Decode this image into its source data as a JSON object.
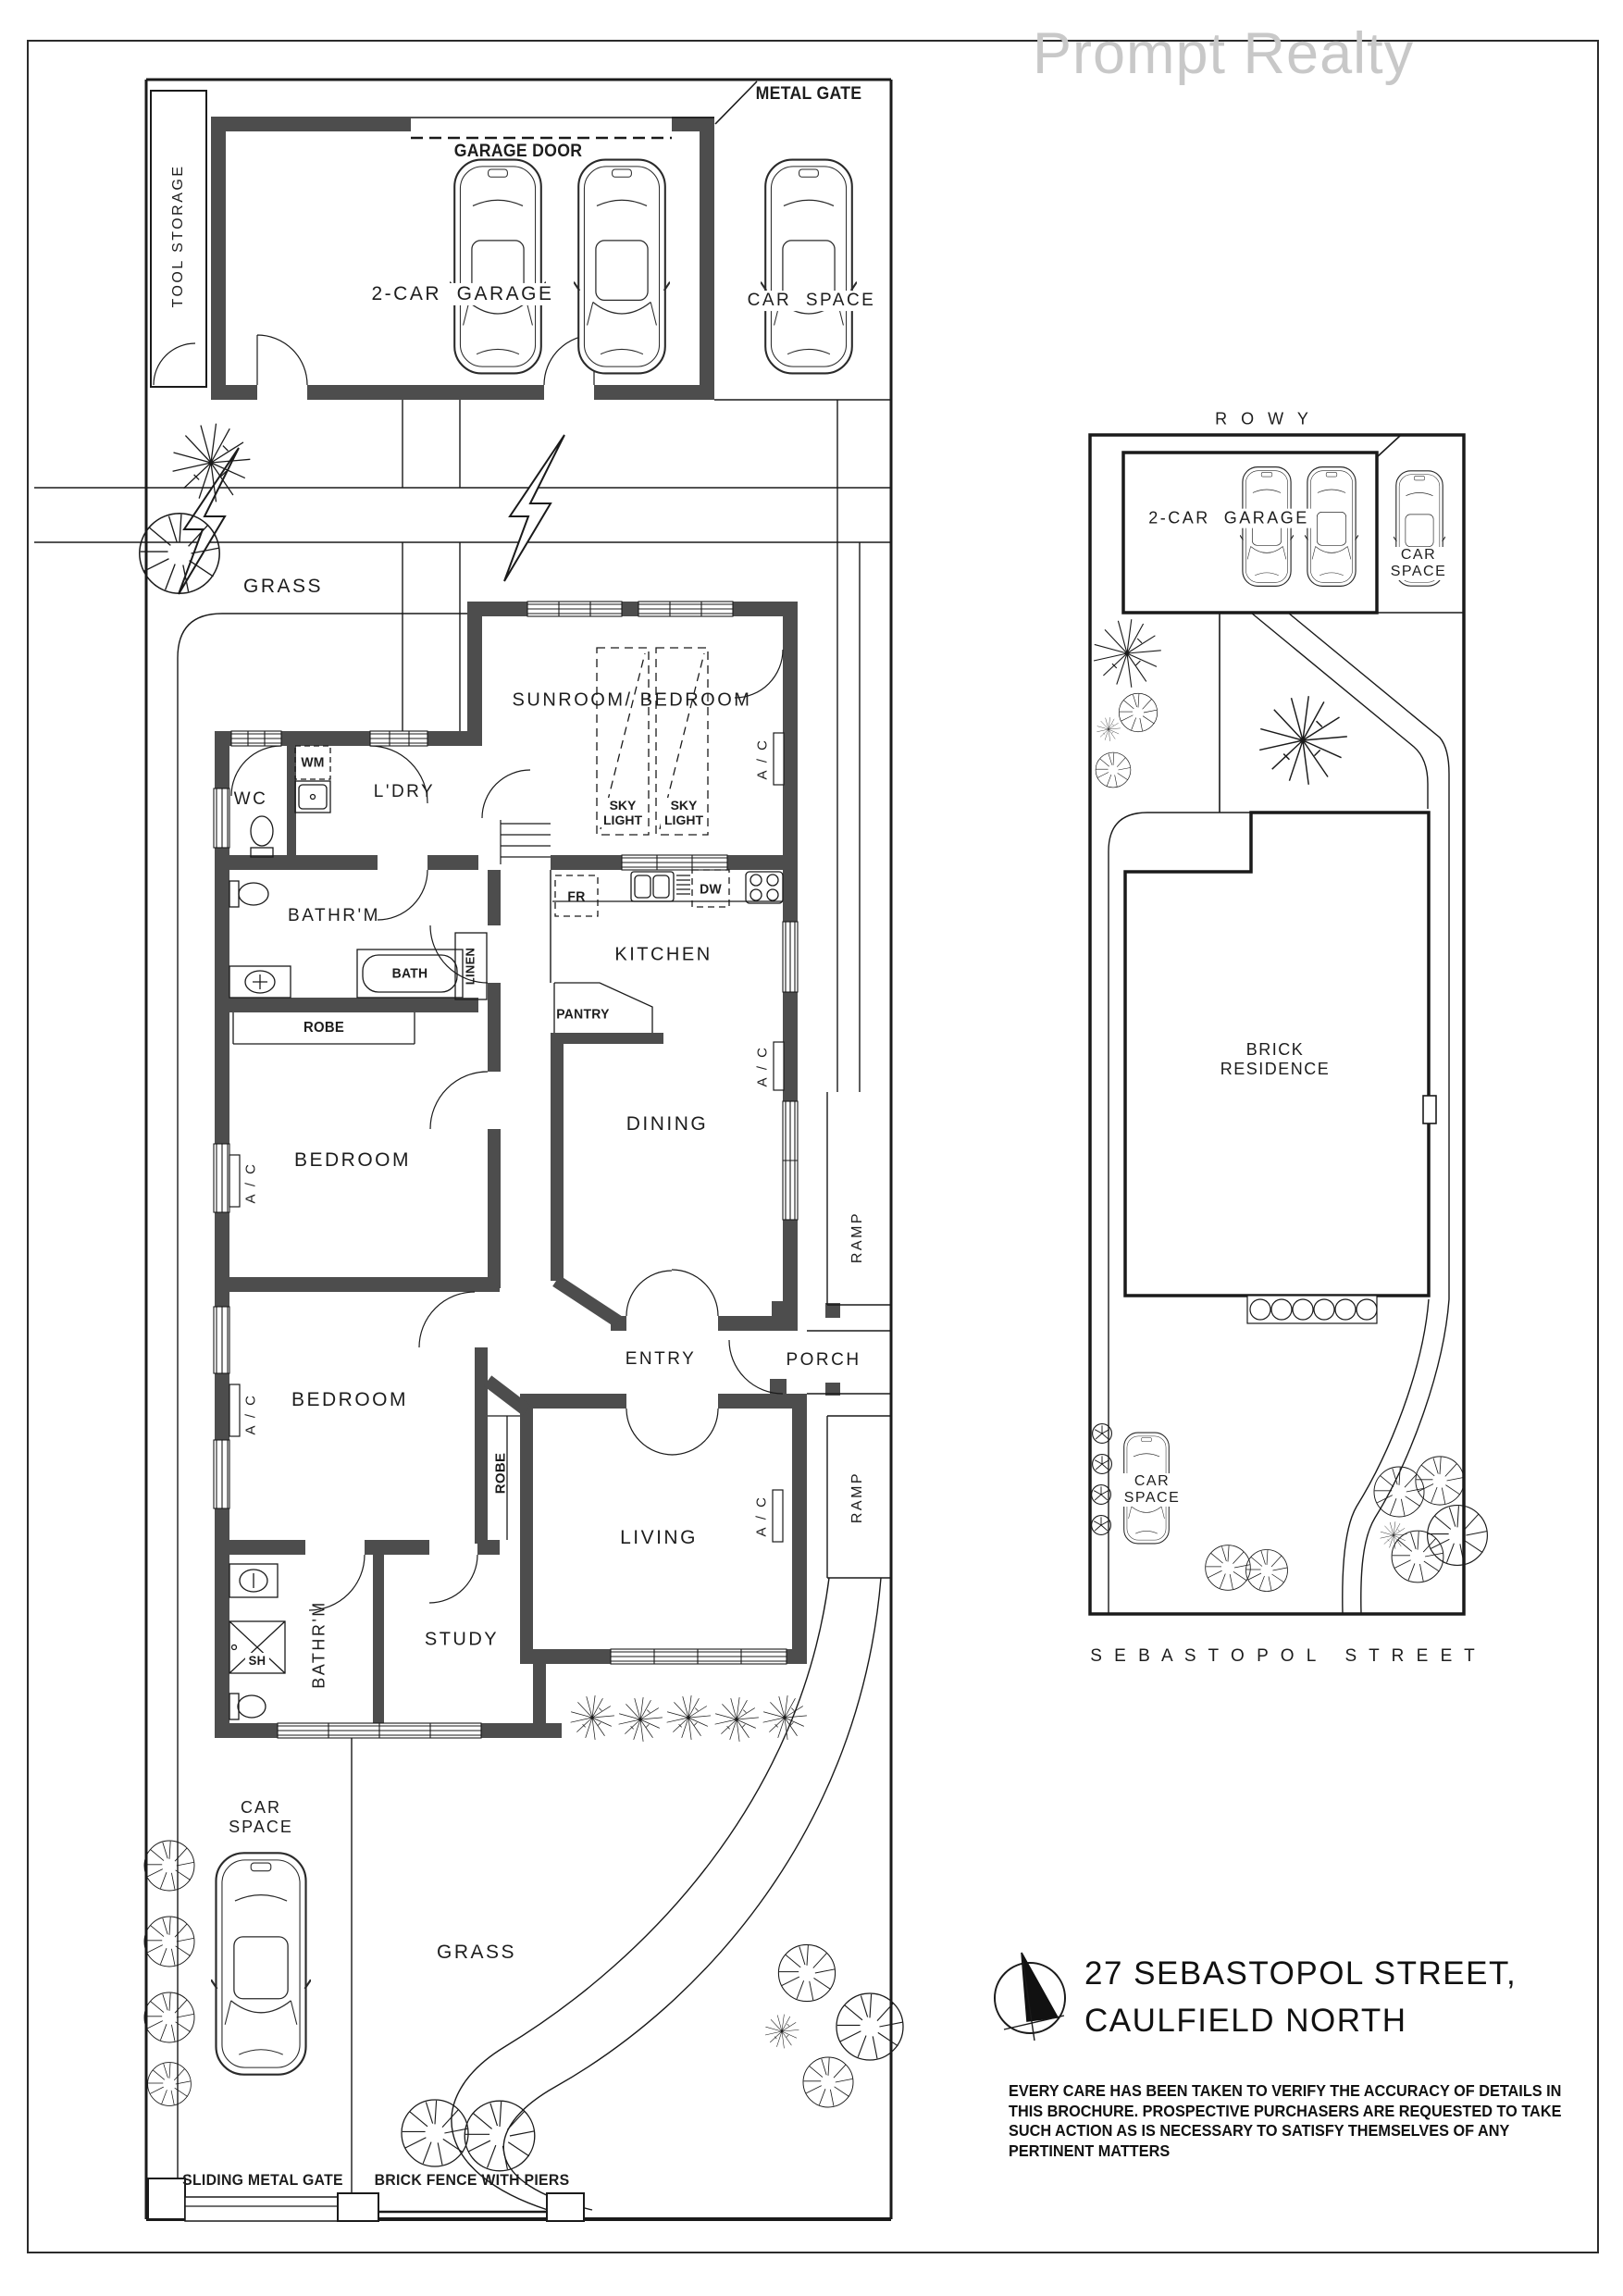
{
  "watermark": "Prompt Realty",
  "floor_plan": {
    "metal_gate": "METAL GATE",
    "garage_door": "GARAGE DOOR",
    "two_car_garage": "2-CAR  GARAGE",
    "car_space": "CAR  SPACE",
    "car_space_line1": "CAR",
    "car_space_line2": "SPACE",
    "tool_storage": "TOOL STORAGE",
    "grass": "GRASS",
    "sunroom_bedroom": "SUNROOM/ BEDROOM",
    "sky_light_line1": "SKY",
    "sky_light_line2": "LIGHT",
    "ac": "A / C",
    "wm": "WM",
    "wc": "WC",
    "laundry": "L'DRY",
    "bathroom": "BATHR'M",
    "bath": "BATH",
    "linen": "LINEN",
    "robe": "ROBE",
    "bedroom": "BEDROOM",
    "fridge": "FR",
    "dishwasher": "DW",
    "kitchen": "KITCHEN",
    "pantry": "PANTRY",
    "dining": "DINING",
    "ramp": "RAMP",
    "entry": "ENTRY",
    "porch": "PORCH",
    "living": "LIVING",
    "shower": "SH",
    "study": "STUDY",
    "sliding_metal_gate": "SLIDING METAL GATE",
    "brick_fence": "BRICK FENCE WITH PIERS"
  },
  "site_plan": {
    "row": "R O W Y",
    "two_car_garage": "2-CAR  GARAGE",
    "car_space_line1": "CAR",
    "car_space_line2": "SPACE",
    "residence_line1": "BRICK",
    "residence_line2": "RESIDENCE",
    "street": "S E B A S T O P O L   S T R E E T"
  },
  "footer": {
    "address_line1": "27 SEBASTOPOL STREET,",
    "address_line2": "CAULFIELD NORTH",
    "disclaimer_line1": "EVERY CARE HAS BEEN TAKEN TO VERIFY THE ACCURACY OF DETAILS IN",
    "disclaimer_line2": "THIS BROCHURE.  PROSPECTIVE PURCHASERS ARE REQUESTED TO TAKE",
    "disclaimer_line3": "SUCH ACTION AS IS NECESSARY TO SATISFY THEMSELVES OF ANY",
    "disclaimer_line4": "PERTINENT MATTERS"
  },
  "colors": {
    "wall": "#4d4d4d",
    "line": "#1a1a1a",
    "watermark": "#c8c8c8"
  }
}
